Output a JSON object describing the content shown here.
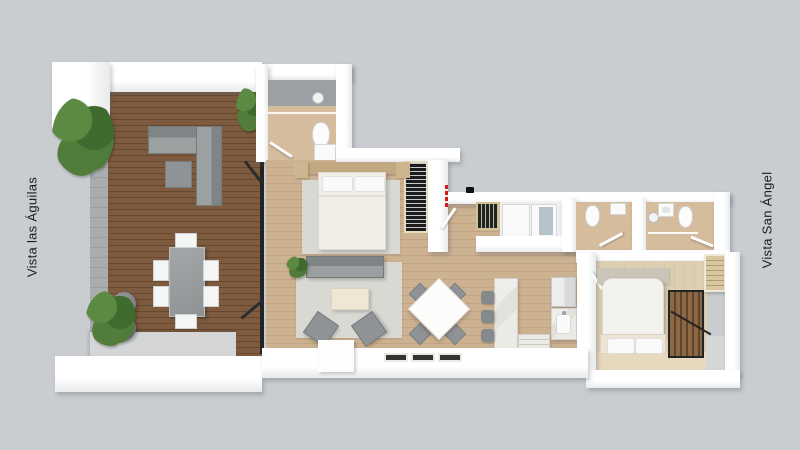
{
  "labels": {
    "left": "Vista las Águilas",
    "right": "Vista San Ángel"
  },
  "colors": {
    "background": "#c9cdd0",
    "wall": "#ffffff",
    "wall_shade": "#e8eaeb",
    "deck_wood": "#7e5b3f",
    "deck_wood_dark": "#66492f",
    "interior_wood": "#cdb292",
    "interior_wood_dark": "#c2a584",
    "light_wood": "#ddd0b2",
    "bath_wood": "#d4bc9c",
    "rug": "#d9d9d3",
    "sofa_gray": "#8f9395",
    "sofa_dark": "#7f8486",
    "concrete": "#d4d6d7",
    "rail_gray": "#a9adae",
    "accent_wall": "#9aa0a3",
    "marble": "#eceae5",
    "plant_green": "#4e7a3a",
    "frame_black": "#242424",
    "accent_red": "#d41c1c",
    "headboard_wood": "#c2a981",
    "closet_beige": "#d9c7a0",
    "white_fixture": "#fafafa"
  },
  "icons": {
    "shower_head": "circle-glyph",
    "entry_marker": "red-dashed-dots",
    "camera_marker": "black-dot"
  }
}
